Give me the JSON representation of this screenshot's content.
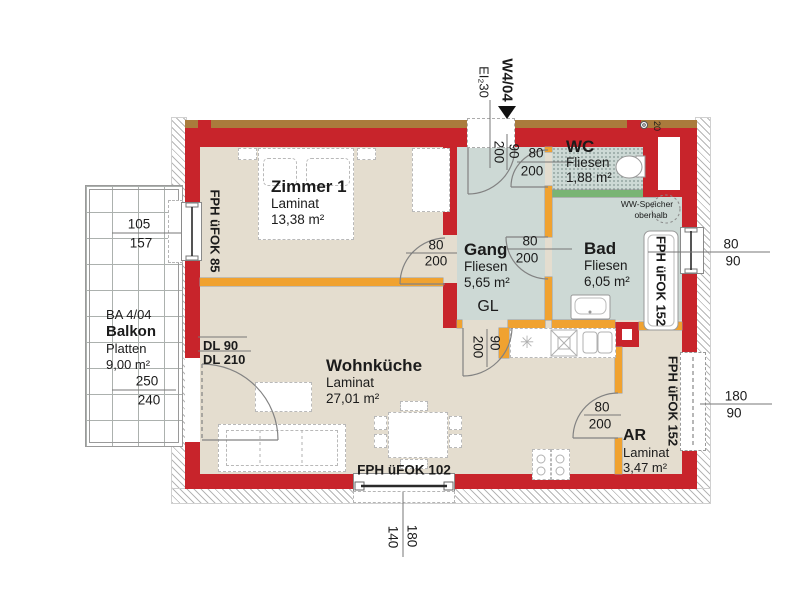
{
  "unit": {
    "label": "W4/04",
    "entry_fire_rating": "EI₂30",
    "entry_dim": {
      "num": "90",
      "den": "200"
    },
    "vent_label": "20"
  },
  "rooms": {
    "zimmer1": {
      "title": "Zimmer 1",
      "floor": "Laminat",
      "area": "13,38 m²",
      "door_dim": {
        "num": "80",
        "den": "200"
      }
    },
    "gang": {
      "title": "Gang",
      "floor": "Fliesen",
      "area": "5,65 m²",
      "gl_label": "GL",
      "door_dim": {
        "num": "90",
        "den": "200"
      }
    },
    "wc": {
      "title": "WC",
      "floor": "Fliesen",
      "area": "1,88 m²",
      "door_dim": {
        "num": "80",
        "den": "200"
      }
    },
    "bad": {
      "title": "Bad",
      "floor": "Fliesen",
      "area": "6,05 m²",
      "door_dim": {
        "num": "80",
        "den": "200"
      },
      "ww_note_line1": "WW-Speicher",
      "ww_note_line2": "oberhalb"
    },
    "wohnkueche": {
      "title": "Wohnküche",
      "floor": "Laminat",
      "area": "27,01 m²"
    },
    "ar": {
      "title": "AR",
      "floor": "Laminat",
      "area": "3,47 m²",
      "door_dim": {
        "num": "80",
        "den": "200"
      }
    },
    "balkon": {
      "code": "BA 4/04",
      "title": "Balkon",
      "floor": "Platten",
      "area": "9,00 m²",
      "dim": {
        "num": "250",
        "den": "240"
      },
      "door_label_line1": "DL 90",
      "door_label_line2": "DL 210"
    }
  },
  "windows": {
    "left": {
      "label": "FPH üFOK 85",
      "dim": {
        "num": "105",
        "den": "157"
      }
    },
    "bad": {
      "label": "FPH üFOK 152",
      "dim": {
        "num": "80",
        "den": "90"
      }
    },
    "ar": {
      "label": "FPH üFOK 152",
      "dim": {
        "num": "180",
        "den": "90"
      }
    },
    "bottom": {
      "label": "FPH üFOK 102",
      "dim": {
        "num": "180",
        "den": "140"
      }
    }
  },
  "colors": {
    "wall_load_bearing": "#c8242b",
    "wall_partition": "#f0a230",
    "wall_glass_divider": "#79b474",
    "floor_laminat": "#e4ddcf",
    "floor_tiles": "#cdd9d5",
    "top_strip": "#aa7b3c"
  }
}
